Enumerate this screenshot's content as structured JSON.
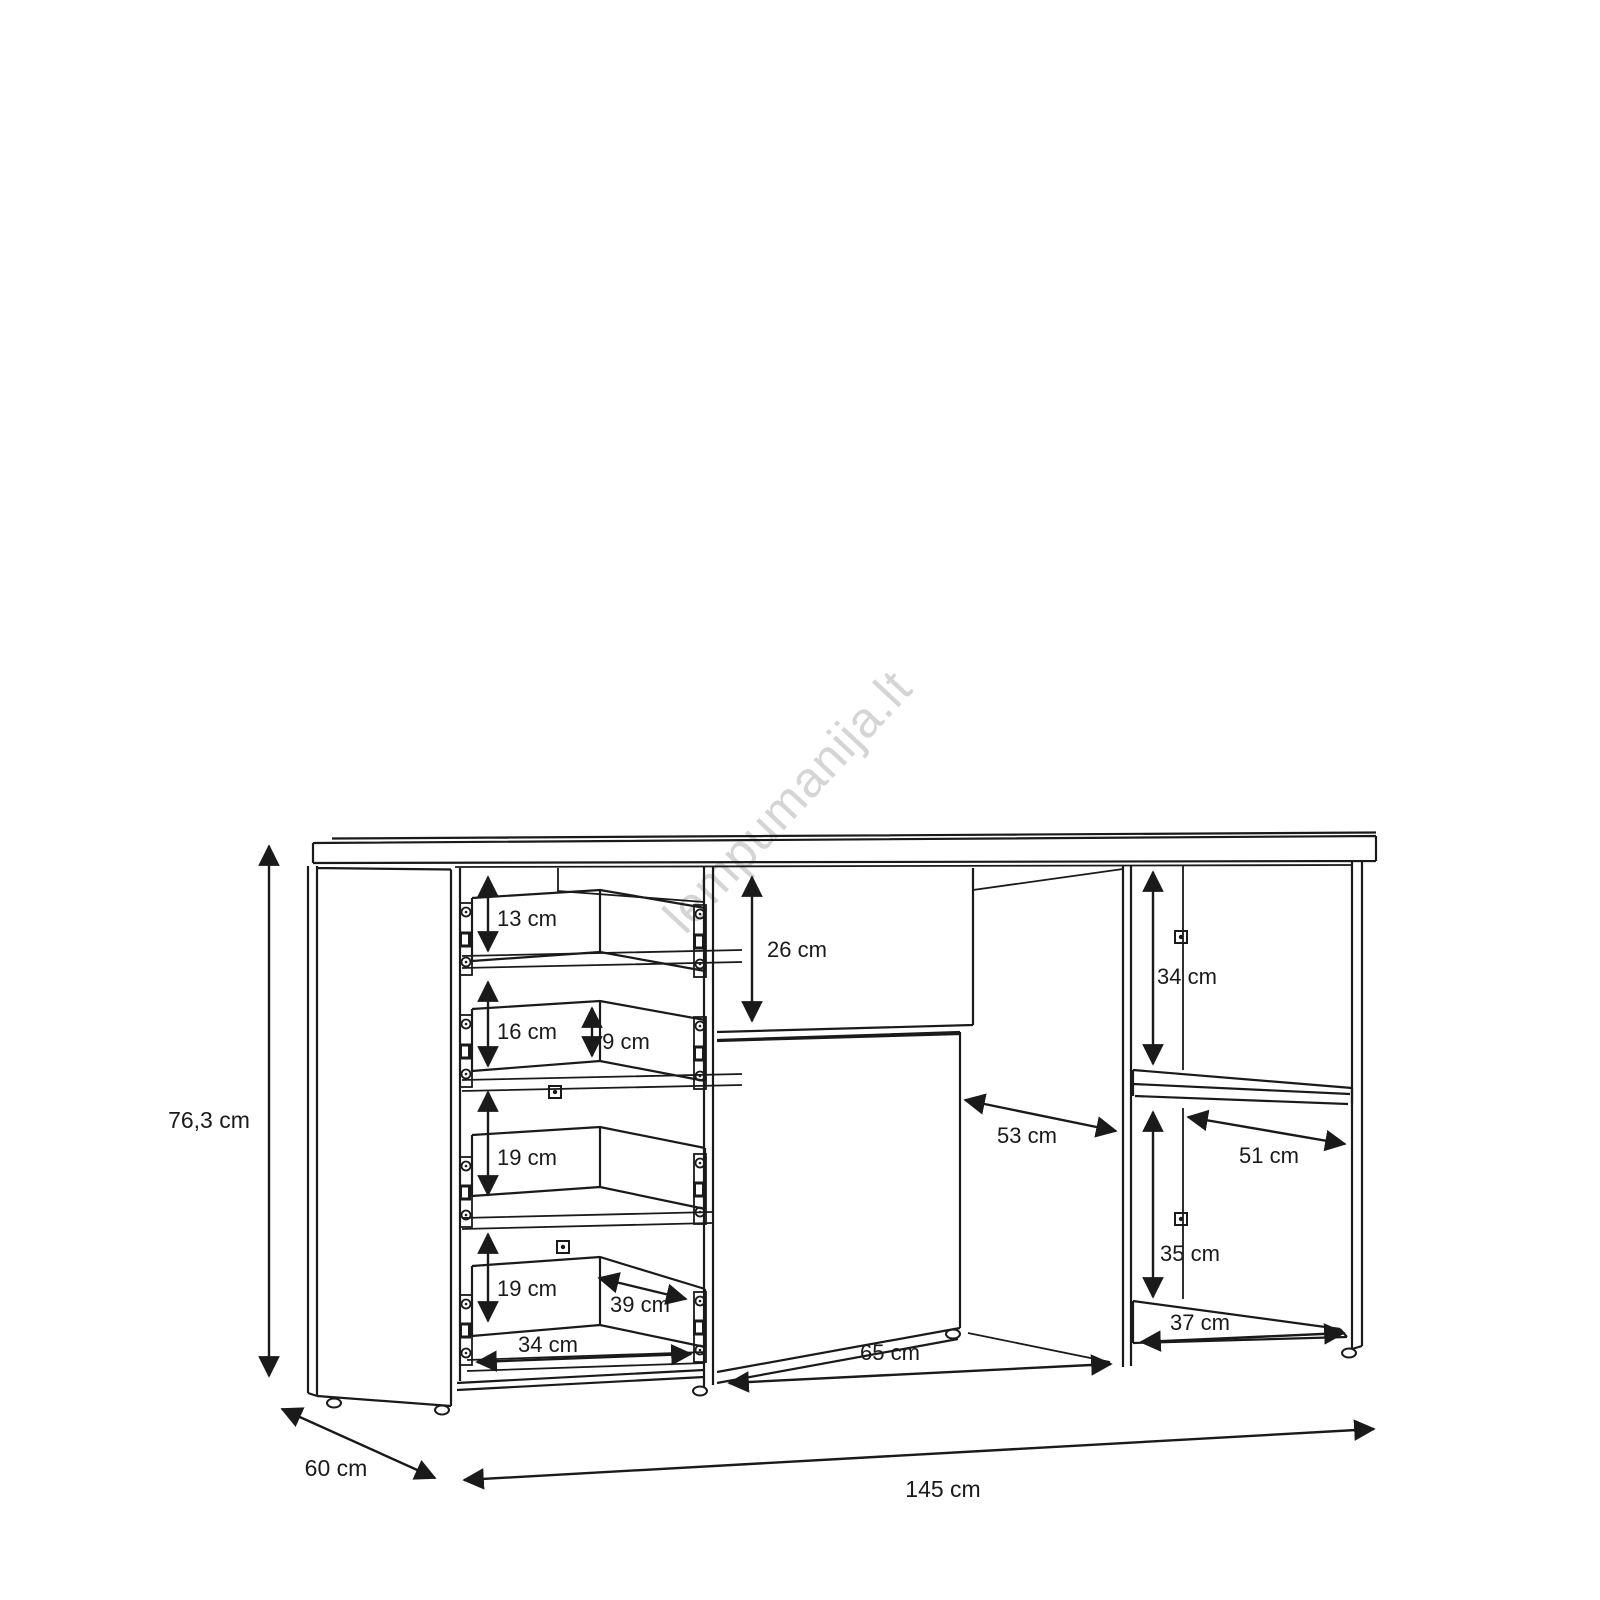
{
  "watermark": {
    "text": "lempumanija.lt",
    "color": "#d5d5d5"
  },
  "diagram": {
    "type": "furniture-dimension-drawing",
    "subject": "sideboard with drawers, doors and open shelves",
    "unit": "cm",
    "colors": {
      "line": "#1a1a1a",
      "background": "#ffffff",
      "watermark": "#d5d5d5"
    },
    "dimensions": {
      "drawer_1_height": {
        "label": "13 cm",
        "value": 13
      },
      "drawer_2_height": {
        "label": "16 cm",
        "value": 16
      },
      "drawer_2_inner_height": {
        "label": "9 cm",
        "value": 9
      },
      "drawer_3_height": {
        "label": "19 cm",
        "value": 19
      },
      "drawer_4_height": {
        "label": "19 cm",
        "value": 19
      },
      "drawer_inner_depth": {
        "label": "39 cm",
        "value": 39
      },
      "drawer_inner_width": {
        "label": "34 cm",
        "value": 34
      },
      "top_drawer_height": {
        "label": "26 cm",
        "value": 26
      },
      "interior_depth": {
        "label": "53 cm",
        "value": 53
      },
      "middle_section_width": {
        "label": "65 cm",
        "value": 65
      },
      "shelf_upper_height": {
        "label": "34 cm",
        "value": 34
      },
      "shelf_inner_depth": {
        "label": "51 cm",
        "value": 51
      },
      "shelf_lower_height": {
        "label": "35 cm",
        "value": 35
      },
      "shelf_inner_width": {
        "label": "37 cm",
        "value": 37
      },
      "total_height": {
        "label": "76,3 cm",
        "value": 76.3
      },
      "total_depth": {
        "label": "60 cm",
        "value": 60
      },
      "total_width": {
        "label": "145 cm",
        "value": 145
      }
    }
  }
}
